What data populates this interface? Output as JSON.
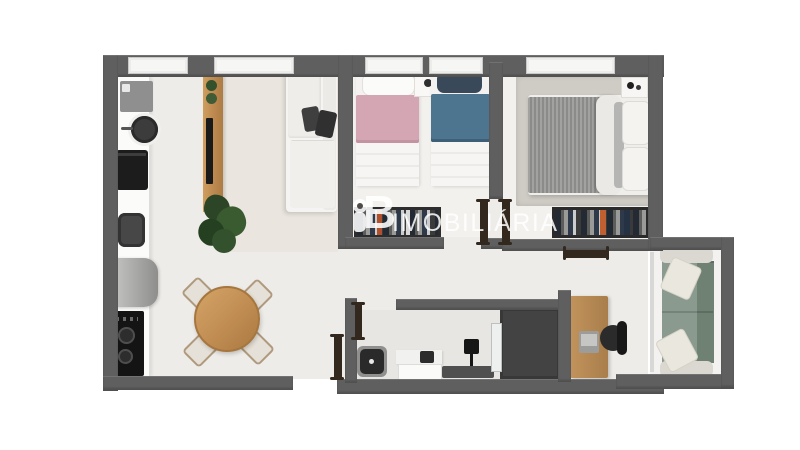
{
  "watermark": {
    "logo_letter": "B",
    "text": "IMOBILIÁRIA"
  },
  "palette": {
    "wall": "#5f5f5f",
    "floor": "#eeece9",
    "floor_light": "#f3f1ee",
    "living_floor": "#eae6df",
    "bath_floor": "#e8e6e3",
    "shower": "#434343",
    "wood": "#c08c52",
    "duvet_pink": "#d4a6b4",
    "duvet_blue": "#4e7590",
    "navy_pillow": "#39495a",
    "master_duvet": "#9a9a98",
    "sofa_white": "#f5f4f2",
    "sofa_green": "#8a9a8e",
    "sofa_green_dark": "#6e8173",
    "appliance_dark": "#1c1c1c",
    "steel": "#a9a9a9",
    "door_brown": "#32281e",
    "plant_green": "#33512c",
    "watermark_color": "#ffffff"
  },
  "scene": {
    "type": "3d-floor-plan-top-view",
    "rooms": [
      "kitchen",
      "living-dining",
      "bedroom-single-pair",
      "master-bedroom",
      "hall",
      "bathroom",
      "home-office",
      "balcony"
    ],
    "furniture": [
      "washing-machine",
      "kitchen-sink",
      "oven",
      "laundry-tank",
      "fridge",
      "cooktop",
      "tv-panel",
      "l-sofa",
      "floor-plant",
      "round-dining-table",
      "dining-chairs",
      "single-bed-pink",
      "single-bed-blue",
      "nightstand",
      "wardrobe",
      "double-bed",
      "master-rug",
      "toilet",
      "vanity",
      "shower-box",
      "glass-partition",
      "bench",
      "desk",
      "laptop",
      "office-chair",
      "green-balcony-sofa",
      "open-doors"
    ]
  }
}
